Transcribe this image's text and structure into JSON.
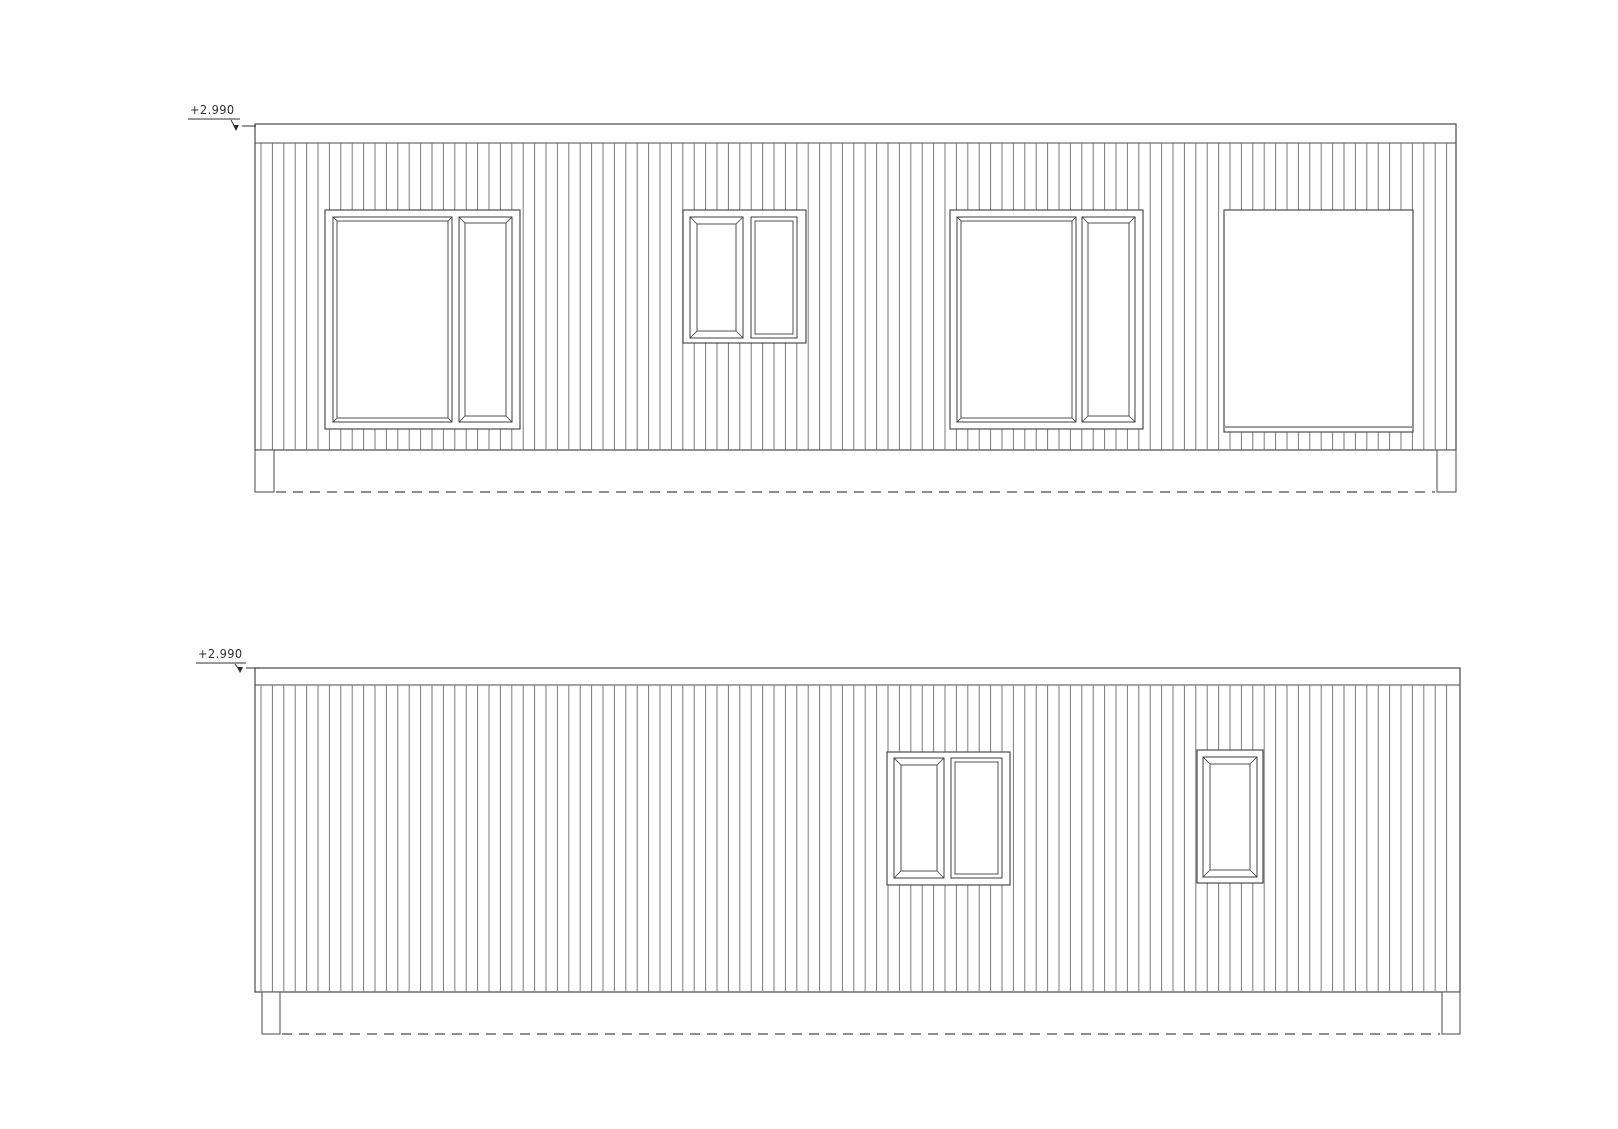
{
  "sheet": {
    "background": "#ffffff",
    "line_color": "#4a4a4a",
    "frame_color": "#3d3d3d",
    "cladding_color": "#7a7a7a",
    "marker_color": "#2f2f2f"
  },
  "drawing": {
    "elevations": [
      {
        "id": "elevation-top",
        "level_label": "+2.990",
        "marker": {
          "text_x": 190,
          "text_y": 104,
          "underline": [
            188,
            240,
            119
          ],
          "arrow": [
            231,
            120,
            236,
            129
          ],
          "dash": [
            242,
            256,
            126
          ]
        },
        "outline": {
          "left": 255,
          "top": 124,
          "right": 1456,
          "fascia_bottom": 143,
          "wall_bottom": 450,
          "base_bottom": 492
        },
        "piers": [
          [
            255,
            274
          ],
          [
            1437,
            1456
          ]
        ],
        "cladding": {
          "start_offset": 6,
          "spacing": 11.4
        },
        "openings": [
          {
            "kind": "window-group",
            "rect": [
              325,
              210,
              195,
              219
            ],
            "panes": [
              {
                "rect": [
                  333,
                  217,
                  119,
                  205
                ],
                "inset": 4,
                "bevel": true
              },
              {
                "rect": [
                  459,
                  217,
                  53,
                  205
                ],
                "inset": 6,
                "bevel": true
              }
            ]
          },
          {
            "kind": "window-group",
            "rect": [
              683,
              210,
              123,
              133
            ],
            "panes": [
              {
                "rect": [
                  690,
                  217,
                  53,
                  121
                ],
                "inset": 7,
                "bevel": true
              },
              {
                "rect": [
                  751,
                  217,
                  46,
                  121
                ],
                "inset": 4,
                "bevel": false
              }
            ]
          },
          {
            "kind": "window-group",
            "rect": [
              950,
              210,
              193,
              219
            ],
            "panes": [
              {
                "rect": [
                  957,
                  217,
                  119,
                  205
                ],
                "inset": 4,
                "bevel": true
              },
              {
                "rect": [
                  1082,
                  217,
                  53,
                  205
                ],
                "inset": 6,
                "bevel": true
              }
            ]
          },
          {
            "kind": "plain-opening",
            "rect": [
              1224,
              210,
              189,
              222
            ],
            "sill_offset": 5
          }
        ]
      },
      {
        "id": "elevation-bottom",
        "level_label": "+2.990",
        "marker": {
          "text_x": 198,
          "text_y": 648,
          "underline": [
            196,
            246,
            663
          ],
          "arrow": [
            235,
            664,
            240,
            671
          ],
          "dash": [
            246,
            260,
            668
          ]
        },
        "outline": {
          "left": 255,
          "top": 668,
          "right": 1460,
          "fascia_bottom": 685,
          "wall_bottom": 992,
          "base_bottom": 1034
        },
        "piers": [
          [
            262,
            280
          ],
          [
            1442,
            1460
          ]
        ],
        "cladding": {
          "start_offset": 6,
          "spacing": 11.4
        },
        "openings": [
          {
            "kind": "window-group",
            "rect": [
              887,
              752,
              123,
              133
            ],
            "panes": [
              {
                "rect": [
                  894,
                  758,
                  50,
                  120
                ],
                "inset": 7,
                "bevel": true
              },
              {
                "rect": [
                  951,
                  758,
                  51,
                  120
                ],
                "inset": 4,
                "bevel": false
              }
            ]
          },
          {
            "kind": "window-group",
            "rect": [
              1197,
              750,
              66,
              133
            ],
            "panes": [
              {
                "rect": [
                  1203,
                  757,
                  54,
                  120
                ],
                "inset": 7,
                "bevel": true
              }
            ]
          }
        ]
      }
    ]
  }
}
